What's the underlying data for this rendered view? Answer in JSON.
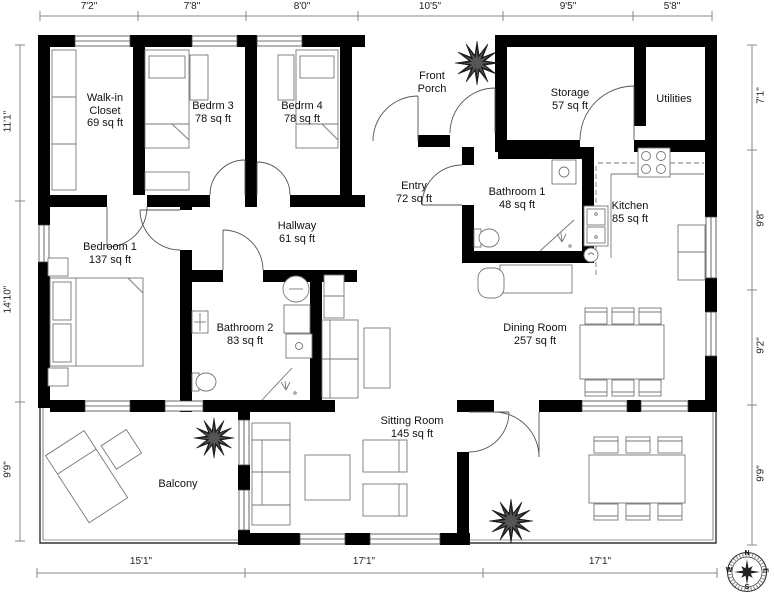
{
  "floor_plan": {
    "title": "Floor plan",
    "rooms": {
      "walk_in_closet": {
        "name": "Walk-in Closet",
        "area": "69 sq ft"
      },
      "bedroom_3": {
        "name": "Bedrm 3",
        "area": "78 sq ft"
      },
      "bedroom_4": {
        "name": "Bedrm 4",
        "area": "78 sq ft"
      },
      "front_porch": {
        "name": "Front Porch"
      },
      "storage": {
        "name": "Storage",
        "area": "57 sq ft"
      },
      "utilities": {
        "name": "Utilities"
      },
      "entry": {
        "name": "Entry",
        "area": "72 sq ft"
      },
      "bathroom_1": {
        "name": "Bathroom 1",
        "area": "48 sq ft"
      },
      "kitchen": {
        "name": "Kitchen",
        "area": "85 sq ft"
      },
      "hallway": {
        "name": "Hallway",
        "area": "61 sq ft"
      },
      "bedroom_1": {
        "name": "Bedroom 1",
        "area": "137 sq ft"
      },
      "bathroom_2": {
        "name": "Bathroom 2",
        "area": "83 sq ft"
      },
      "dining_room": {
        "name": "Dining Room",
        "area": "257 sq ft"
      },
      "sitting_room": {
        "name": "Sitting Room",
        "area": "145 sq ft"
      },
      "balcony": {
        "name": "Balcony"
      }
    },
    "dimensions": {
      "top": [
        "7'2\"",
        "7'8\"",
        "8'0\"",
        "10'5\"",
        "9'5\"",
        "5'8\""
      ],
      "bottom": [
        "15'1\"",
        "17'1\"",
        "17'1\""
      ],
      "left": [
        "11'1\"",
        "14'10\"",
        "9'9\""
      ],
      "right": [
        "7'1\"",
        "9'8\"",
        "9'2\"",
        "9'9\""
      ]
    },
    "compass": {
      "north": "N",
      "east": "E",
      "south": "S",
      "west": "W"
    },
    "colors": {
      "walls": "#000000",
      "background": "#ffffff",
      "furniture_outline": "#666666",
      "dimension_lines": "#888888"
    }
  }
}
